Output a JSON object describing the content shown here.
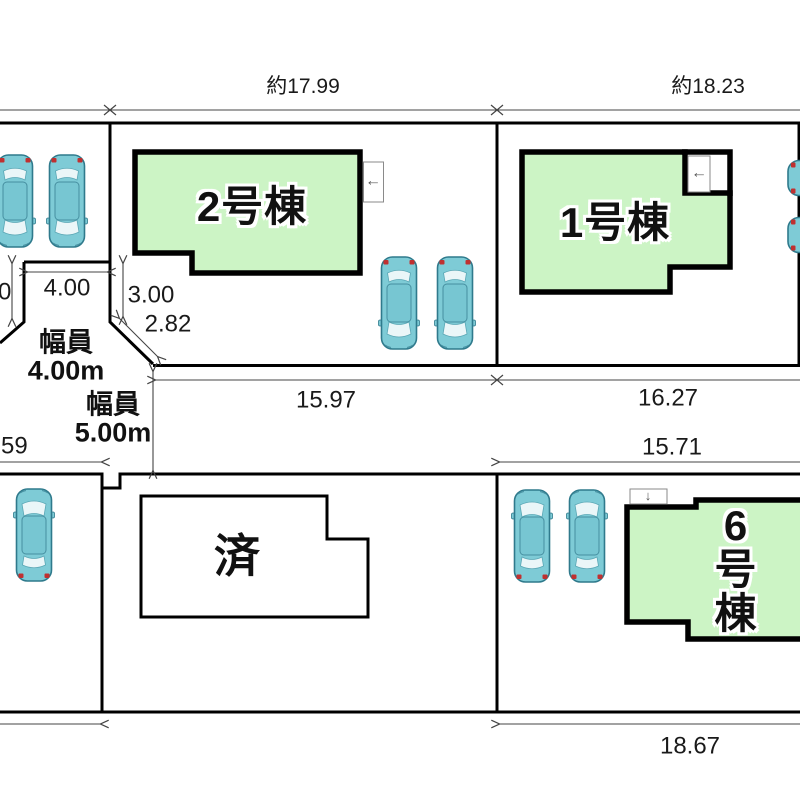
{
  "plan": {
    "top_dims": {
      "lot2_width": "約17.99",
      "lot1_width": "約18.23"
    },
    "buildings": {
      "b2": "2号棟",
      "b1": "1号棟",
      "b6": "6号棟",
      "sold": "済"
    },
    "roads": {
      "road4_width_label": "幅員\n4.00m",
      "road5_width_label": "幅員\n5.00m"
    },
    "dims": {
      "d400": "4.00",
      "d300": "3.00",
      "d282": "2.82",
      "d0": "0",
      "d1597": "15.97",
      "d1627": "16.27",
      "d1571": "15.71",
      "d59": "59",
      "d1867": "18.67"
    },
    "icons": {
      "entry_left_arrow": "←",
      "entry_down_arrow": "↓"
    },
    "colors": {
      "building_fill": "#ccf4c5",
      "building_border": "#000000",
      "car_body": "#7ecbd6",
      "car_outline": "#2f7a8c",
      "tail_light": "#c03030",
      "boundary_line": "#000000",
      "dimension_line": "#444444"
    }
  }
}
